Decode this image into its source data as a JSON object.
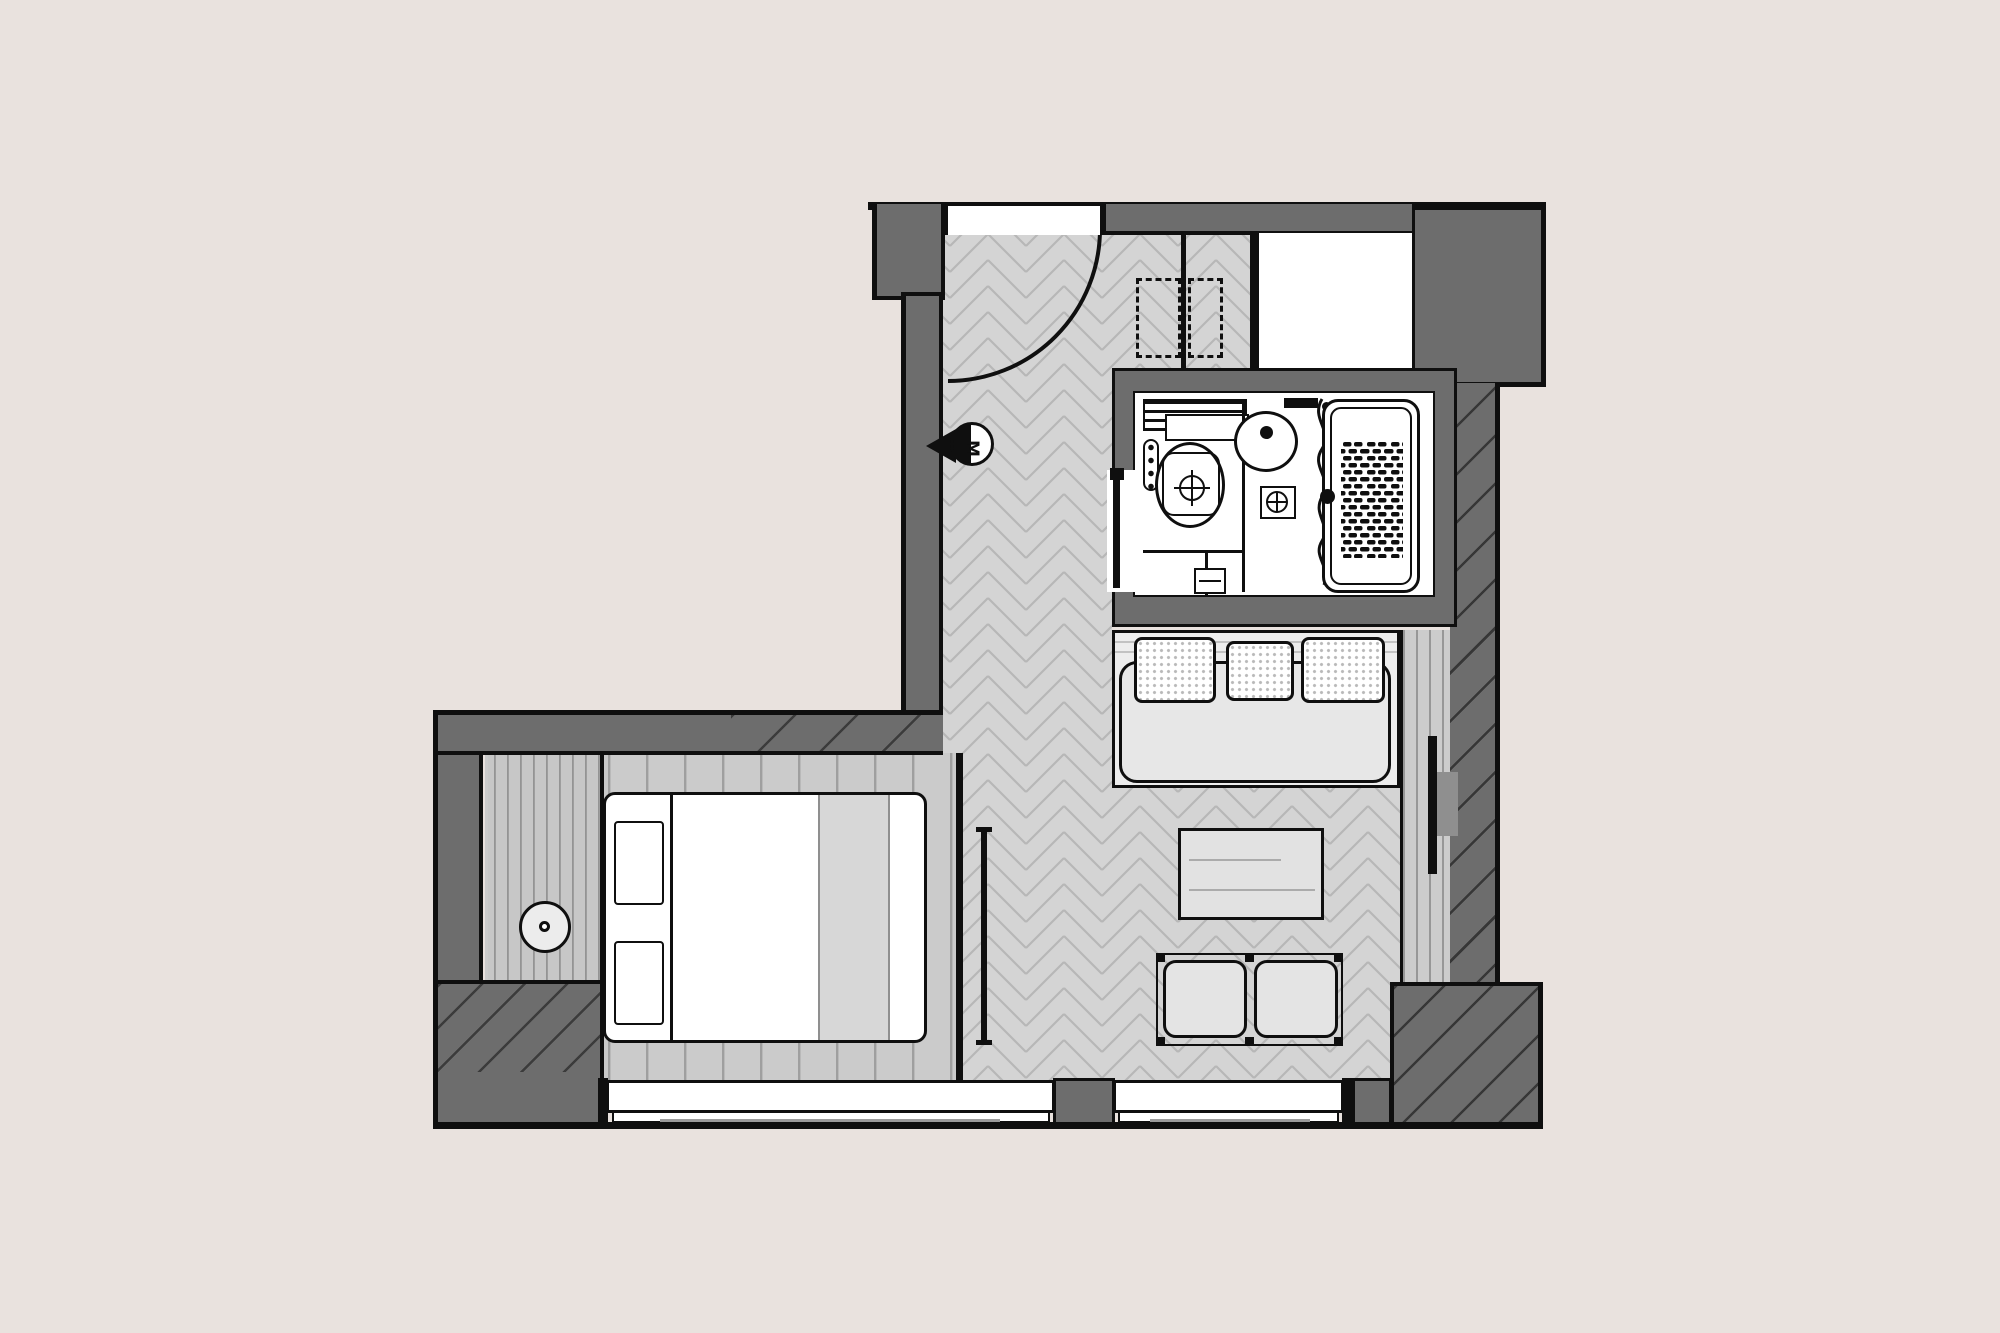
{
  "meta": {
    "type": "architectural floor plan",
    "view": "top-down",
    "subject": "studio guest room with bathroom"
  },
  "symbols": {
    "door_marker": "M"
  },
  "colors": {
    "bg": "#e9e2de",
    "wall": "#6d6d6d",
    "line": "#0f0f0f",
    "paper": "#ffffff",
    "herringbone": "#d4d4d4",
    "herringbone_seam": "#b7b7b7",
    "plank": "#cbcbcb",
    "plank2": "#cccccc",
    "plankline": "#979797",
    "seat": "#e7e7e7",
    "duvet": "#d7d7d7",
    "table": "#e2e2e2",
    "mount": "#8f8f8f"
  },
  "rooms": [
    {
      "id": "entry-hall",
      "floor": "herringbone parquet",
      "features": [
        "entry swing door",
        "wall door-marker symbol"
      ]
    },
    {
      "id": "closet",
      "features": [
        "two dashed hanging-rail bays"
      ]
    },
    {
      "id": "bathroom",
      "fixtures": [
        "vanity shelf",
        "toilet with cistern",
        "round basin",
        "floor drain",
        "shower curtain",
        "bathtub with anti-slip mat",
        "towel rail"
      ]
    },
    {
      "id": "living-area",
      "furniture": [
        "three-cushion sofa",
        "coffee table",
        "two ottomans",
        "wall-mounted tv",
        "media console strip"
      ]
    },
    {
      "id": "sleeping-nook",
      "furniture": [
        "double bed with two pillows",
        "bedside shelf",
        "round table lamp"
      ],
      "floor": "wood planks"
    },
    {
      "id": "service-shaft",
      "note": "white void beside closet"
    }
  ],
  "openings": [
    {
      "id": "entry-door",
      "type": "hinged door, quarter-circle swing"
    },
    {
      "id": "bathroom-door",
      "type": "pocket door in left bathroom wall"
    },
    {
      "id": "window-left",
      "type": "window in bottom wall"
    },
    {
      "id": "window-right",
      "type": "window in bottom wall"
    }
  ]
}
